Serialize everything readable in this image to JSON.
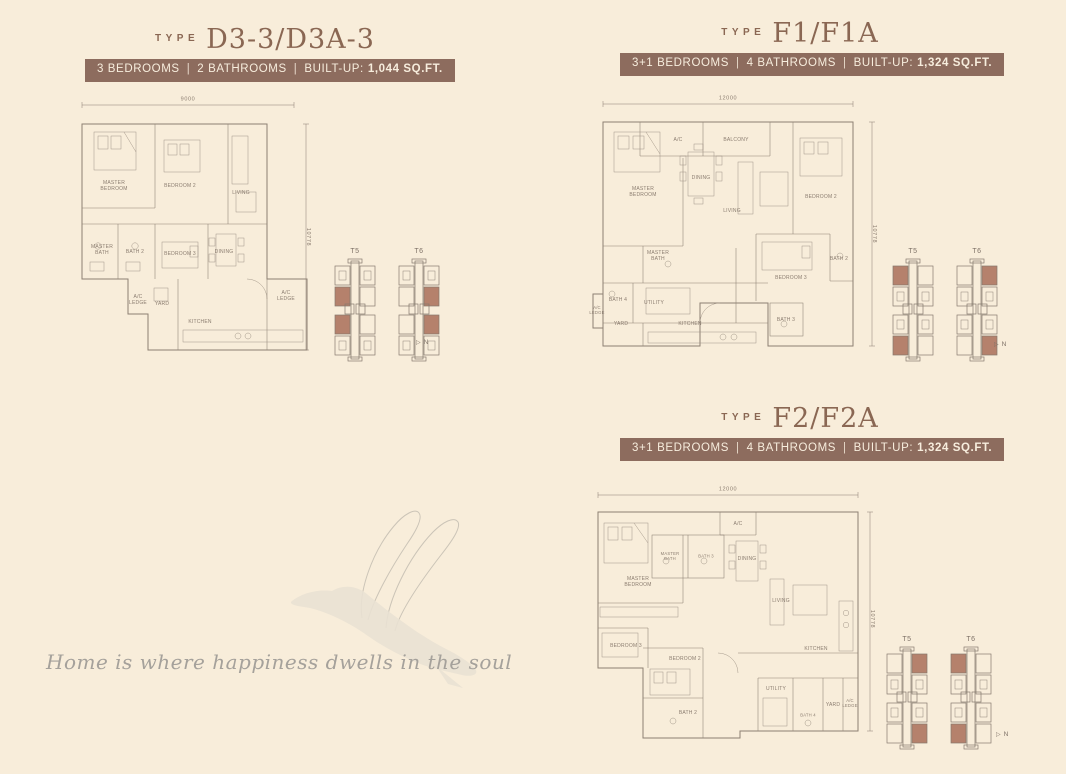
{
  "page": {
    "background": "#f8edda"
  },
  "colors": {
    "page_bg": "#f8edda",
    "accent_brown": "#8a6753",
    "badge_bg": "#8d6c5e",
    "badge_text": "#f7eddd",
    "plan_line": "#8d8073",
    "unit_highlight": "#b5816c",
    "quote_gray": "#a5a19b"
  },
  "icons": {
    "north_arrow": "▷"
  },
  "north_label": "N",
  "quote": "Home is where happiness dwells in the soul",
  "plans": [
    {
      "type_label": "TYPE",
      "name": "D3-3/D3A-3",
      "sep": "|",
      "bedrooms": "3 BEDROOMS",
      "bathrooms": "2 BATHROOMS",
      "builtup_label": "BUILT-UP:",
      "builtup_value": "1,044 SQ.FT.",
      "dims": {
        "width": "9000",
        "height": "10778"
      },
      "rooms": [
        "MASTER BEDROOM",
        "BEDROOM 2",
        "LIVING",
        "MASTER BATH",
        "BATH 2",
        "BEDROOM 3",
        "DINING",
        "YARD",
        "A/C LEDGE",
        "KITCHEN",
        "A/C LEDGE"
      ],
      "keyplans": [
        "T5",
        "T6"
      ]
    },
    {
      "type_label": "TYPE",
      "name": "F1/F1A",
      "sep": "|",
      "bedrooms": "3+1 BEDROOMS",
      "bathrooms": "4 BATHROOMS",
      "builtup_label": "BUILT-UP:",
      "builtup_value": "1,324 SQ.FT.",
      "dims": {
        "width": "12000",
        "height": "10778"
      },
      "rooms": [
        "A/C",
        "BALCONY",
        "MASTER BEDROOM",
        "DINING",
        "LIVING",
        "BEDROOM 2",
        "MASTER BATH",
        "BATH 2",
        "BEDROOM 3",
        "BATH 4",
        "UTILITY",
        "A/C LEDGE",
        "YARD",
        "KITCHEN",
        "BATH 3"
      ],
      "keyplans": [
        "T5",
        "T6"
      ]
    },
    {
      "type_label": "TYPE",
      "name": "F2/F2A",
      "sep": "|",
      "bedrooms": "3+1 BEDROOMS",
      "bathrooms": "4 BATHROOMS",
      "builtup_label": "BUILT-UP:",
      "builtup_value": "1,324 SQ.FT.",
      "dims": {
        "width": "12000",
        "height": "10778"
      },
      "rooms": [
        "A/C",
        "MASTER BEDROOM",
        "MASTER BATH",
        "BATH 3",
        "DINING",
        "LIVING",
        "BEDROOM 3",
        "BEDROOM 2",
        "BATH 2",
        "KITCHEN",
        "UTILITY",
        "BATH 4",
        "YARD",
        "A/C LEDGE"
      ],
      "keyplans": [
        "T5",
        "T6"
      ]
    }
  ]
}
